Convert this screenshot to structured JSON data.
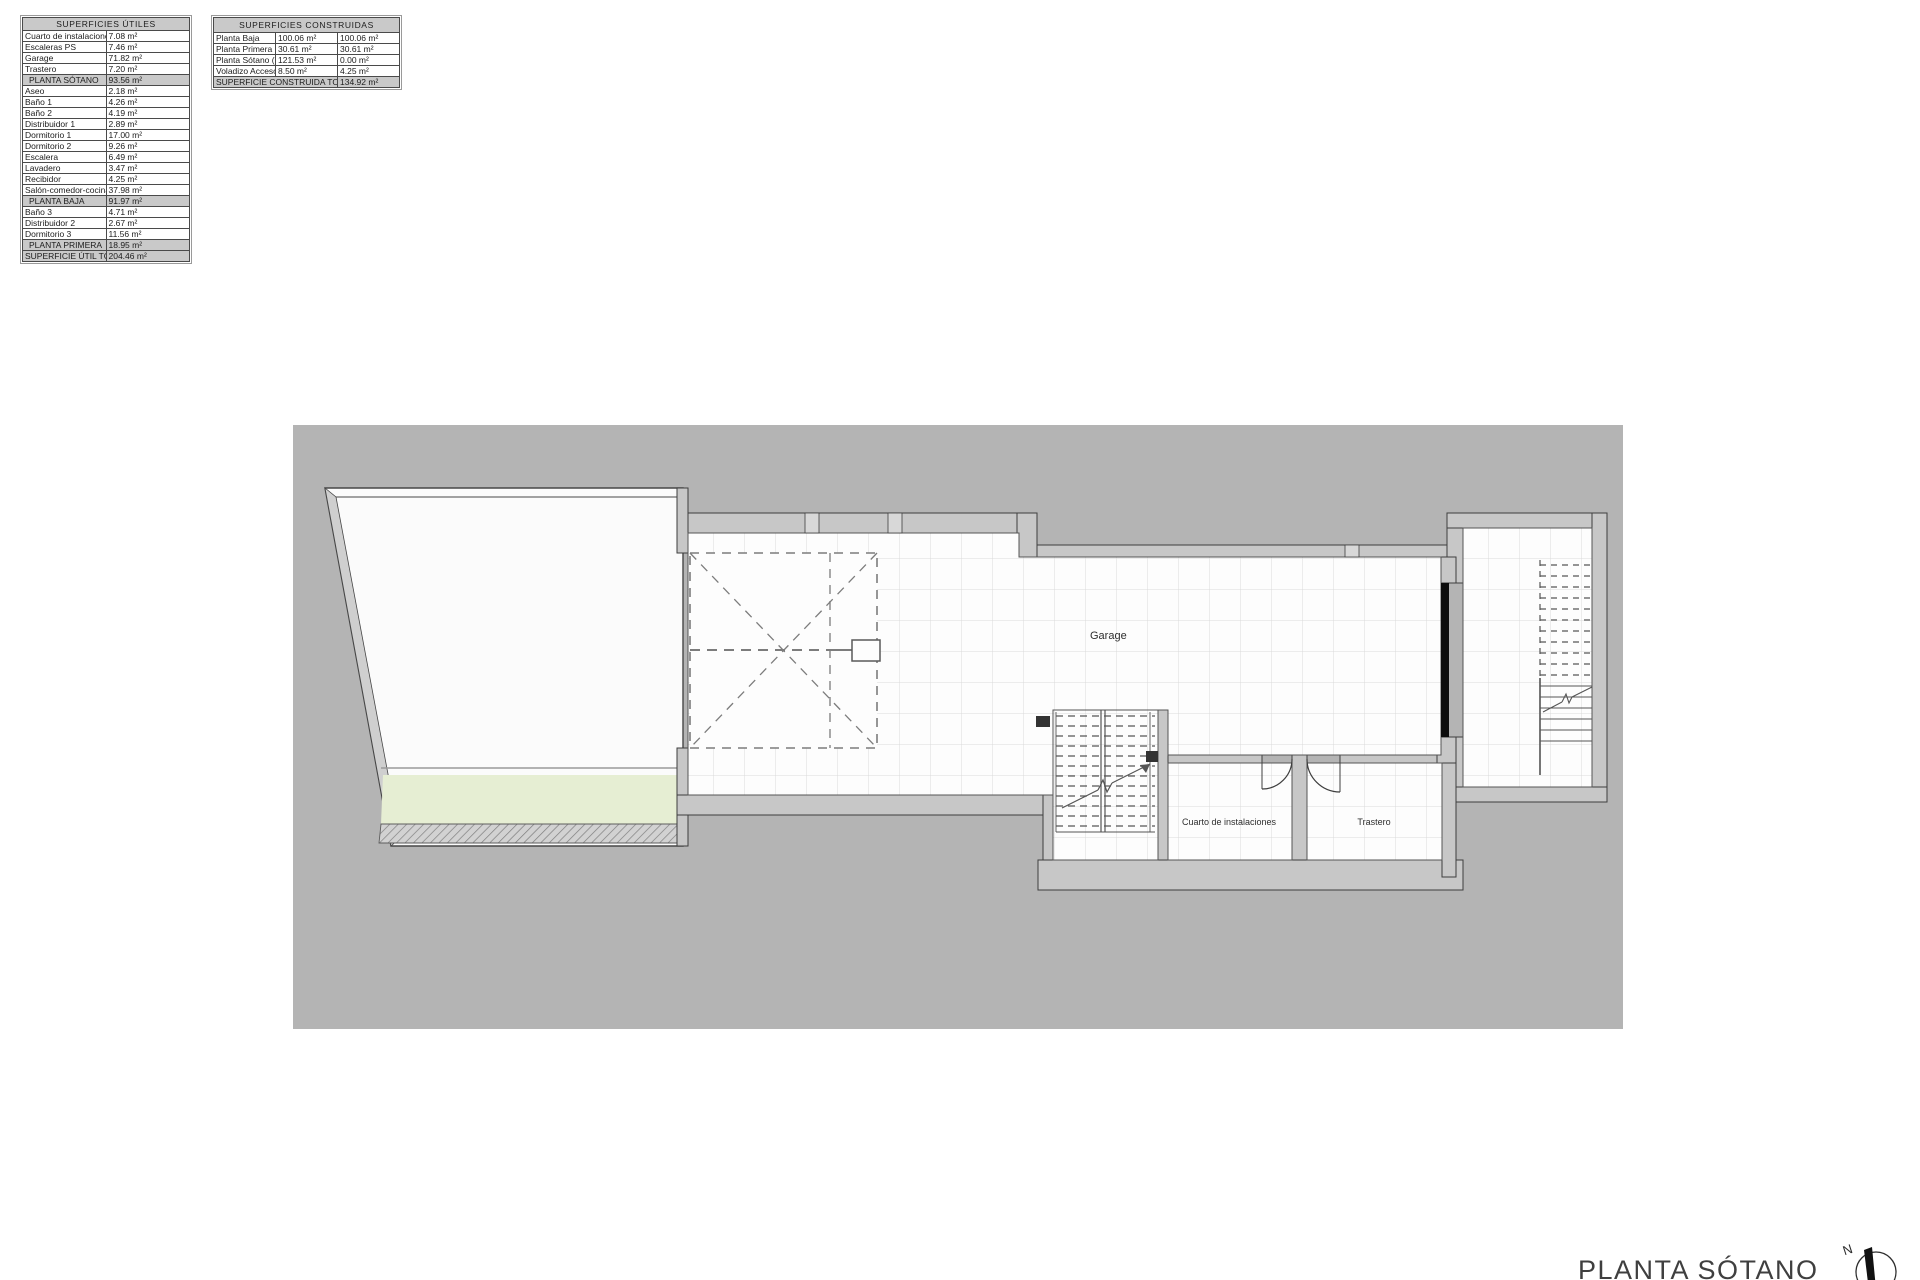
{
  "tables": {
    "utiles": {
      "title": "SUPERFICIES ÚTILES",
      "rows": [
        {
          "label": "Cuarto de instalaciones",
          "value": "7.08 m²",
          "type": "item"
        },
        {
          "label": "Escaleras PS",
          "value": "7.46 m²",
          "type": "item"
        },
        {
          "label": "Garage",
          "value": "71.82 m²",
          "type": "item"
        },
        {
          "label": "Trastero",
          "value": "7.20 m²",
          "type": "item"
        },
        {
          "label": "PLANTA SÓTANO",
          "value": "93.56 m²",
          "type": "subtotal"
        },
        {
          "label": "Aseo",
          "value": "2.18 m²",
          "type": "item"
        },
        {
          "label": "Baño 1",
          "value": "4.26 m²",
          "type": "item"
        },
        {
          "label": "Baño 2",
          "value": "4.19 m²",
          "type": "item"
        },
        {
          "label": "Distribuidor 1",
          "value": "2.89 m²",
          "type": "item"
        },
        {
          "label": "Dormitorio 1",
          "value": "17.00 m²",
          "type": "item"
        },
        {
          "label": "Dormitorio 2",
          "value": "9.26 m²",
          "type": "item"
        },
        {
          "label": "Escalera",
          "value": "6.49 m²",
          "type": "item"
        },
        {
          "label": "Lavadero",
          "value": "3.47 m²",
          "type": "item"
        },
        {
          "label": "Recibidor",
          "value": "4.25 m²",
          "type": "item"
        },
        {
          "label": "Salón-comedor-cocina",
          "value": "37.98 m²",
          "type": "item"
        },
        {
          "label": "PLANTA BAJA",
          "value": "91.97 m²",
          "type": "subtotal"
        },
        {
          "label": "Baño 3",
          "value": "4.71 m²",
          "type": "item"
        },
        {
          "label": "Distribuidor 2",
          "value": "2.67 m²",
          "type": "item"
        },
        {
          "label": "Dormitorio 3",
          "value": "11.56 m²",
          "type": "item"
        },
        {
          "label": "PLANTA PRIMERA",
          "value": "18.95 m²",
          "type": "subtotal"
        },
        {
          "label": "SUPERFICIE ÚTIL TOTAL",
          "value": "204.46 m²",
          "type": "total"
        }
      ]
    },
    "construidas": {
      "title": "SUPERFICIES CONSTRUIDAS",
      "rows": [
        {
          "label": "Planta Baja",
          "v1": "100.06 m²",
          "v2": "100.06 m²"
        },
        {
          "label": "Planta Primera",
          "v1": "30.61 m²",
          "v2": "30.61 m²"
        },
        {
          "label": "Planta Sótano (0%)",
          "v1": "121.53 m²",
          "v2": "0.00 m²"
        },
        {
          "label": "Voladizo Acceso(50%)",
          "v1": "8.50 m²",
          "v2": "4.25 m²"
        }
      ],
      "total": {
        "label": "SUPERFICIE CONSTRUIDA TOTAL",
        "value": "134.92 m²"
      }
    }
  },
  "plan": {
    "rooms": {
      "garage": "Garage",
      "cuarto": "Cuarto de instalaciones",
      "trastero": "Trastero"
    },
    "title": "PLANTA SÓTANO",
    "compass_label": "N"
  },
  "colors": {
    "plan_background": "#b4b4b4",
    "wall_fill": "#c7c7c7",
    "wall_line": "#3e3e3e",
    "floor": "#fdfdfd",
    "grid_line": "#dadada",
    "green_strip": "#e6eed3",
    "table_header_bg": "#c9c9c9",
    "black_wall": "#0d0d0d"
  }
}
